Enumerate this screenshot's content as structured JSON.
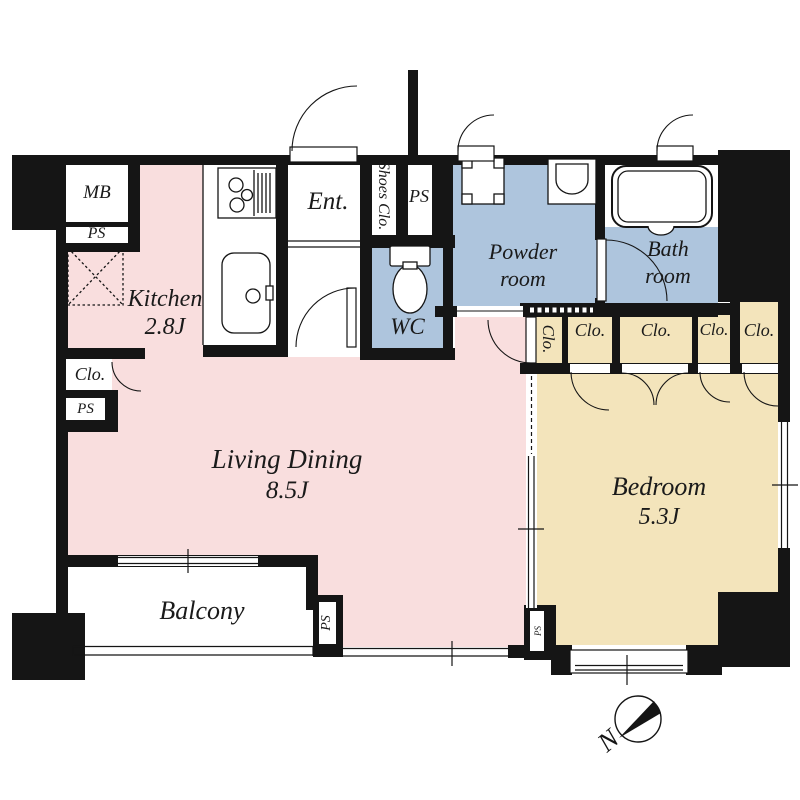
{
  "title": "1LDK apartment floor plan",
  "colors": {
    "living": "#f9dede",
    "wet": "#aec5dd",
    "bedroom": "#f3e4bb",
    "wall": "#151515"
  },
  "rooms": {
    "kitchen_name": "Kitchen",
    "kitchen_size": "2.8J",
    "living_name": "Living Dining",
    "living_size": "8.5J",
    "bedroom_name": "Bedroom",
    "bedroom_size": "5.3J",
    "powder_line1": "Powder",
    "powder_line2": "room",
    "bath_line1": "Bath",
    "bath_line2": "room",
    "wc": "WC",
    "entrance": "Ent.",
    "balcony": "Balcony",
    "shoes_closet": "Shoes Clo."
  },
  "labels": {
    "meter_box": "MB",
    "pipe_space": "PS",
    "closet": "Clo.",
    "north": "N"
  }
}
